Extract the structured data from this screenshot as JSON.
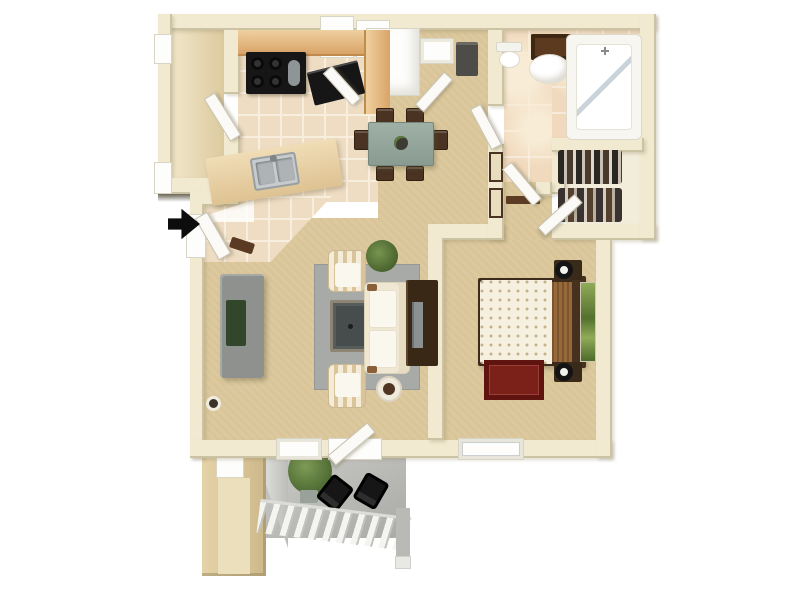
{
  "scene": {
    "kind": "apartment-floor-plan-3d-render",
    "view": "top-down",
    "text_visible": false,
    "indicators": {
      "entry_arrow": {
        "shape": "arrow",
        "direction": "right",
        "color": "#0d0d0d"
      }
    }
  },
  "palette": {
    "bg": "#ffffff",
    "wall": "#f1ead0",
    "wallShadow": "#6e6a5c",
    "carpet": "#d9c598",
    "tileKitchen": "#eedcc3",
    "tileGrout": "#f8eedd",
    "tileBath": "#f0d9bd",
    "tileBathLight": "#f8ecd6",
    "utilityFloor": "#e9dab6",
    "closetFloor": "#f2ecda",
    "patio": "#cbccc8",
    "patioDark": "#a9aaa6",
    "counterWood": "#d9a468",
    "counterWoodLight": "#efd09f",
    "counterTan": "#e6cda4",
    "applianceBlack": "#161616",
    "steel": "#c7cbcd",
    "white": "#fdfdfb",
    "tableSage": "#94a59b",
    "chairBrown": "#4a3322",
    "sofaCream": "#efe7d2",
    "cushionWhite": "#faf7ee",
    "stripeTan": "#d9c49c",
    "rugGray": "#a7aaa6",
    "coffeeTableGray": "#565c5c",
    "coffeeTableFrame": "#8d8474",
    "consoleGray": "#8f918e",
    "greenDark": "#31462a",
    "plantGreen": "#5d7a3e",
    "armoireBrown": "#3a2817",
    "tvGray": "#8b9093",
    "bedCream": "#f6f0e0",
    "bedDot": "#c4b08a",
    "blanketBrown": "#96683a",
    "headboardBrown": "#46301e",
    "nightstandBrown": "#3a2a1a",
    "rugRed": "#7c201a",
    "artGreen1": "#90ab58",
    "artGreen2": "#55702f",
    "mirrorBrown": "#5c3a20",
    "fridgeGray": "#4e4c48"
  },
  "rooms": [
    {
      "id": "utility-room",
      "floor": "vinyl-tan",
      "furniture": []
    },
    {
      "id": "kitchen",
      "floor": "tile",
      "furniture": [
        "upper-cabinet",
        "upper-cabinet",
        "wood-counter",
        "range-stove",
        "black-counter-appliance",
        "peninsula-counter",
        "double-basin-sink",
        "bar-stool",
        "utility-door"
      ]
    },
    {
      "id": "dining-area",
      "floor": "carpet",
      "furniture": [
        "dining-table",
        "plant-centerpiece",
        "dining-chair x6",
        "pantry-double-doors",
        "entry-alcove",
        "window",
        "refrigerator-cabinet"
      ]
    },
    {
      "id": "entry",
      "floor": "tile",
      "furniture": [
        "entry-door",
        "entry-arrow"
      ]
    },
    {
      "id": "bathroom",
      "floor": "tile-mottled",
      "furniture": [
        "toilet",
        "pedestal-sink",
        "mirror-cabinet",
        "bathtub-shower",
        "bathroom-door"
      ]
    },
    {
      "id": "walk-in-closet",
      "floor": "cream",
      "furniture": [
        "hanging-clothes",
        "hanging-clothes",
        "closet-door"
      ]
    },
    {
      "id": "hallway",
      "floor": "carpet",
      "furniture": [
        "storage-panel-doors",
        "shelf",
        "hall-door"
      ]
    },
    {
      "id": "living-room",
      "floor": "carpet",
      "furniture": [
        "media-console",
        "area-rug",
        "coffee-table",
        "striped-armchair",
        "striped-armchair",
        "sofa",
        "potted-plant",
        "tv-armoire",
        "television",
        "side-table",
        "floor-decor-circle",
        "window",
        "sliding-patio-door"
      ]
    },
    {
      "id": "bedroom",
      "floor": "carpet",
      "furniture": [
        "bed",
        "headboard",
        "nightstand-with-lamp",
        "nightstand-with-lamp",
        "accent-rug-red",
        "wall-art-green",
        "window"
      ]
    },
    {
      "id": "patio",
      "floor": "concrete",
      "furniture": [
        "patio-chair",
        "patio-chair",
        "potted-plant",
        "railing",
        "support-pillar",
        "storage-nook"
      ]
    }
  ]
}
